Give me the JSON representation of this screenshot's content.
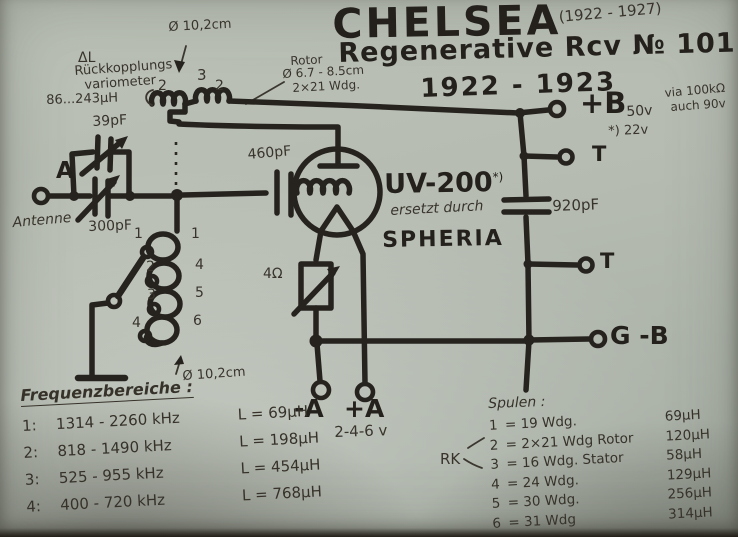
{
  "title": {
    "line1": "CHELSEA",
    "years_note": "(1922 - 1927)",
    "line2": "Regenerative Rcv № 101",
    "line3": "1922 - 1923"
  },
  "variometer": {
    "delta_label": "ΔL",
    "name_line1": "Rückkopplungs",
    "name_line2": "variometer",
    "inductance_range": "86...243μH",
    "diameter": "Ø 10,2cm",
    "rotor_label": "Rotor",
    "rotor_diameter": "Ø 6.7 - 8.5cm",
    "rotor_windings": "2×21 Wdg.",
    "coil_number_left": "2",
    "coil_number_mid": "3",
    "coil_number_right": "2"
  },
  "antenna": {
    "terminal": "A",
    "label": "Antenne",
    "cap_top": "39pF",
    "cap_main": "300pF"
  },
  "tube": {
    "grid_cap": "460pF",
    "name": "UV-200",
    "footnote_mark": "*)",
    "replaced_by_line1": "ersetzt durch",
    "replaced_by_line2": "SPHERIA",
    "rheostat": "4Ω"
  },
  "right_terminals": {
    "plus_b": "+B",
    "plus_b_voltage": "50v",
    "plus_b_alt": "*) 22v",
    "note_line1": "via 100kΩ",
    "note_line2": "auch 90v",
    "t1": "T",
    "bypass_cap": "920pF",
    "t2": "T",
    "g_minus_b": "G -B"
  },
  "filament": {
    "minus_a": "-A",
    "plus_a": "+A",
    "voltage": "2-4-6 v"
  },
  "tuning_coil": {
    "tap_numbers": [
      "1",
      "2",
      "3",
      "4"
    ],
    "section_numbers": [
      "1",
      "4",
      "5",
      "6"
    ],
    "diameter": "Ø 10,2cm"
  },
  "frequency_ranges": {
    "heading": "Frequenzbereiche :",
    "rows": [
      {
        "num": "1:",
        "range": "1314 - 2260 kHz",
        "l": "L = 69μH"
      },
      {
        "num": "2:",
        "range": "818 - 1490 kHz",
        "l": "L = 198μH"
      },
      {
        "num": "3:",
        "range": "525 - 955 kHz",
        "l": "L = 454μH"
      },
      {
        "num": "4:",
        "range": "400 - 720 kHz",
        "l": "L = 768μH"
      }
    ]
  },
  "coil_table": {
    "heading": "Spulen :",
    "rk_label": "RK",
    "rows": [
      {
        "num": "1",
        "winding": "= 19 Wdg.",
        "value": "69μH"
      },
      {
        "num": "2",
        "winding": "= 2×21 Wdg  Rotor",
        "value": "120μH"
      },
      {
        "num": "3",
        "winding": "= 16 Wdg.  Stator",
        "value": "58μH"
      },
      {
        "num": "4",
        "winding": "= 24 Wdg.",
        "value": "129μH"
      },
      {
        "num": "5",
        "winding": "= 30 Wdg.",
        "value": "256μH"
      },
      {
        "num": "6",
        "winding": "= 31 Wdg",
        "value": "314μH"
      }
    ]
  }
}
